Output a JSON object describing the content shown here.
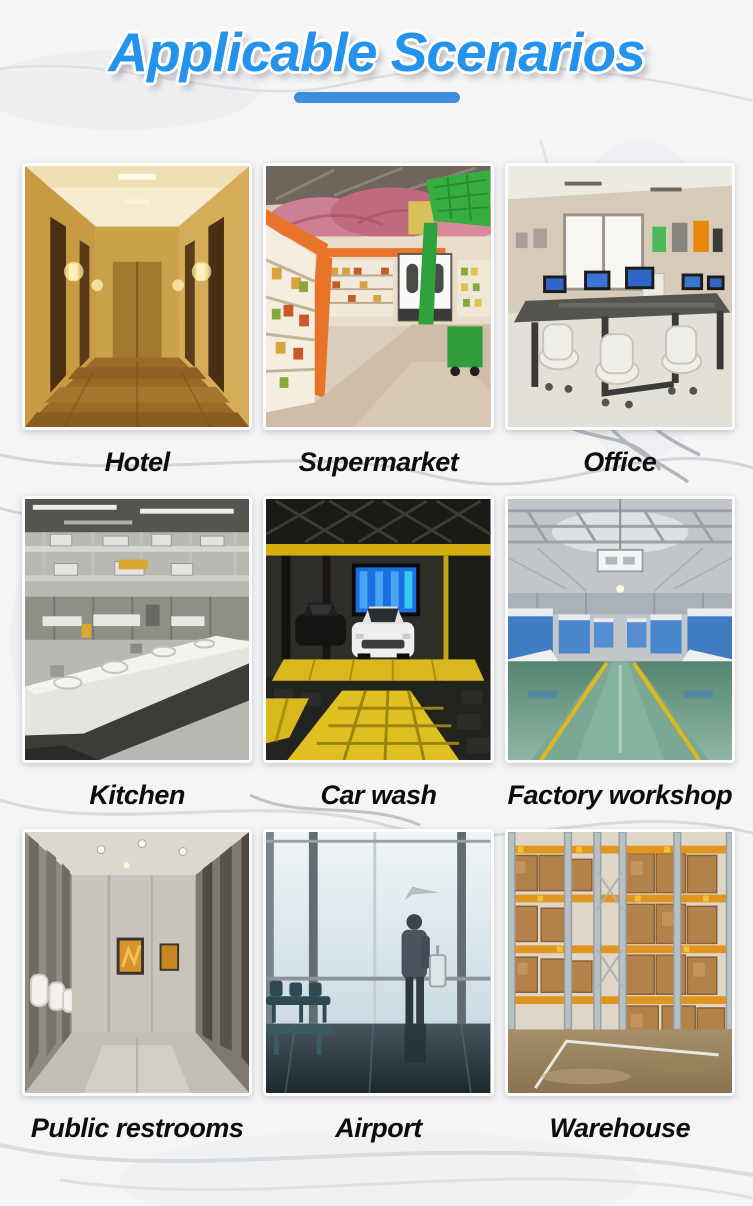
{
  "page": {
    "title": "Applicable Scenarios",
    "accent_color": "#2493ee",
    "underline_color": "#3e8ede",
    "label_color": "#0d0d0d"
  },
  "scenarios": [
    {
      "id": "hotel",
      "label": "Hotel"
    },
    {
      "id": "supermarket",
      "label": "Supermarket"
    },
    {
      "id": "office",
      "label": "Office"
    },
    {
      "id": "kitchen",
      "label": "Kitchen"
    },
    {
      "id": "car-wash",
      "label": "Car wash"
    },
    {
      "id": "factory-workshop",
      "label": "Factory workshop"
    },
    {
      "id": "public-restrooms",
      "label": "Public restrooms"
    },
    {
      "id": "airport",
      "label": "Airport"
    },
    {
      "id": "warehouse",
      "label": "Warehouse"
    }
  ]
}
